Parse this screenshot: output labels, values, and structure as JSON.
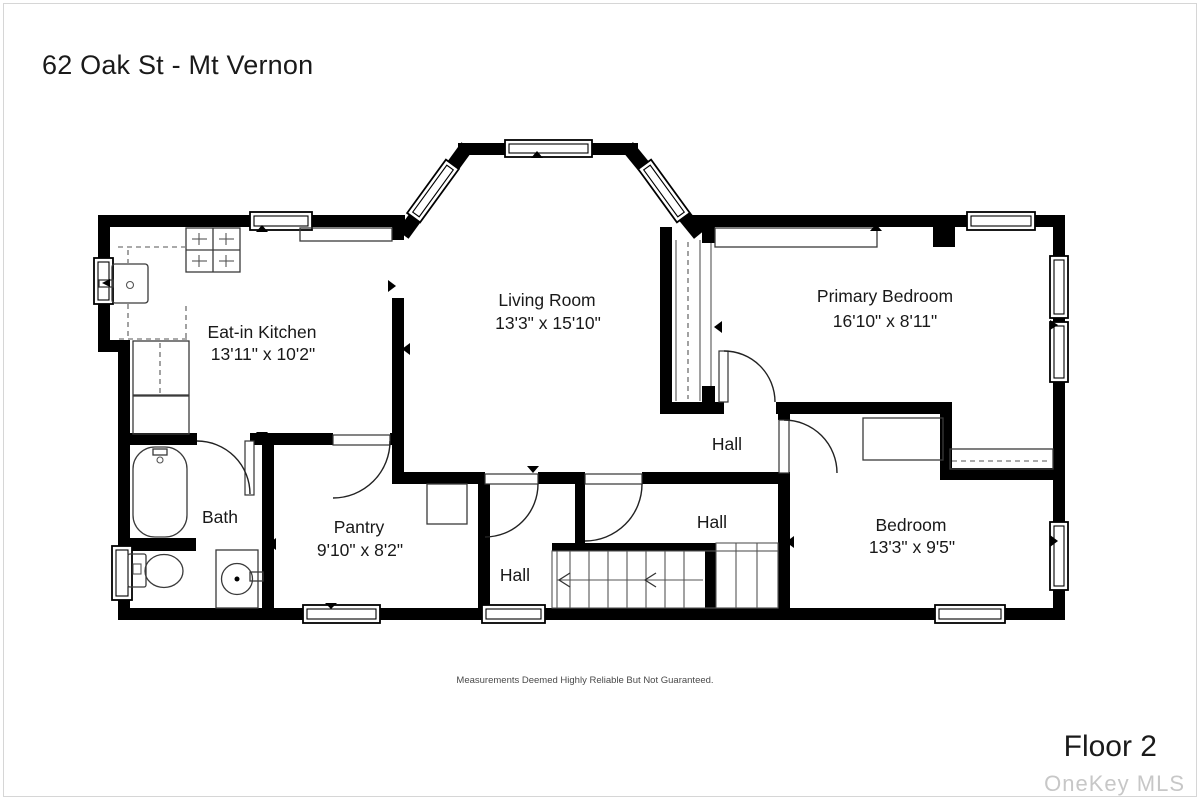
{
  "header": {
    "title": "62 Oak St - Mt Vernon"
  },
  "footer": {
    "floor_label": "Floor 2",
    "watermark": "OneKey MLS",
    "disclaimer": "Measurements Deemed Highly Reliable But Not Guaranteed."
  },
  "rooms": {
    "kitchen": {
      "name": "Eat-in Kitchen",
      "dims": "13'11\" x 10'2\""
    },
    "living": {
      "name": "Living Room",
      "dims": "13'3\" x 15'10\""
    },
    "primary": {
      "name": "Primary Bedroom",
      "dims": "16'10\" x 8'11\""
    },
    "bedroom": {
      "name": "Bedroom",
      "dims": "13'3\" x 9'5\""
    },
    "pantry": {
      "name": "Pantry",
      "dims": "9'10\" x 8'2\""
    },
    "bath": {
      "name": "Bath"
    },
    "hall_upper": {
      "name": "Hall"
    },
    "hall_middle": {
      "name": "Hall"
    },
    "hall_lower": {
      "name": "Hall"
    }
  },
  "colors": {
    "walls": "#000000",
    "label_text": "#191919",
    "watermark_text": "#c7c7c7",
    "disclaimer_text": "#4a4a4a"
  }
}
